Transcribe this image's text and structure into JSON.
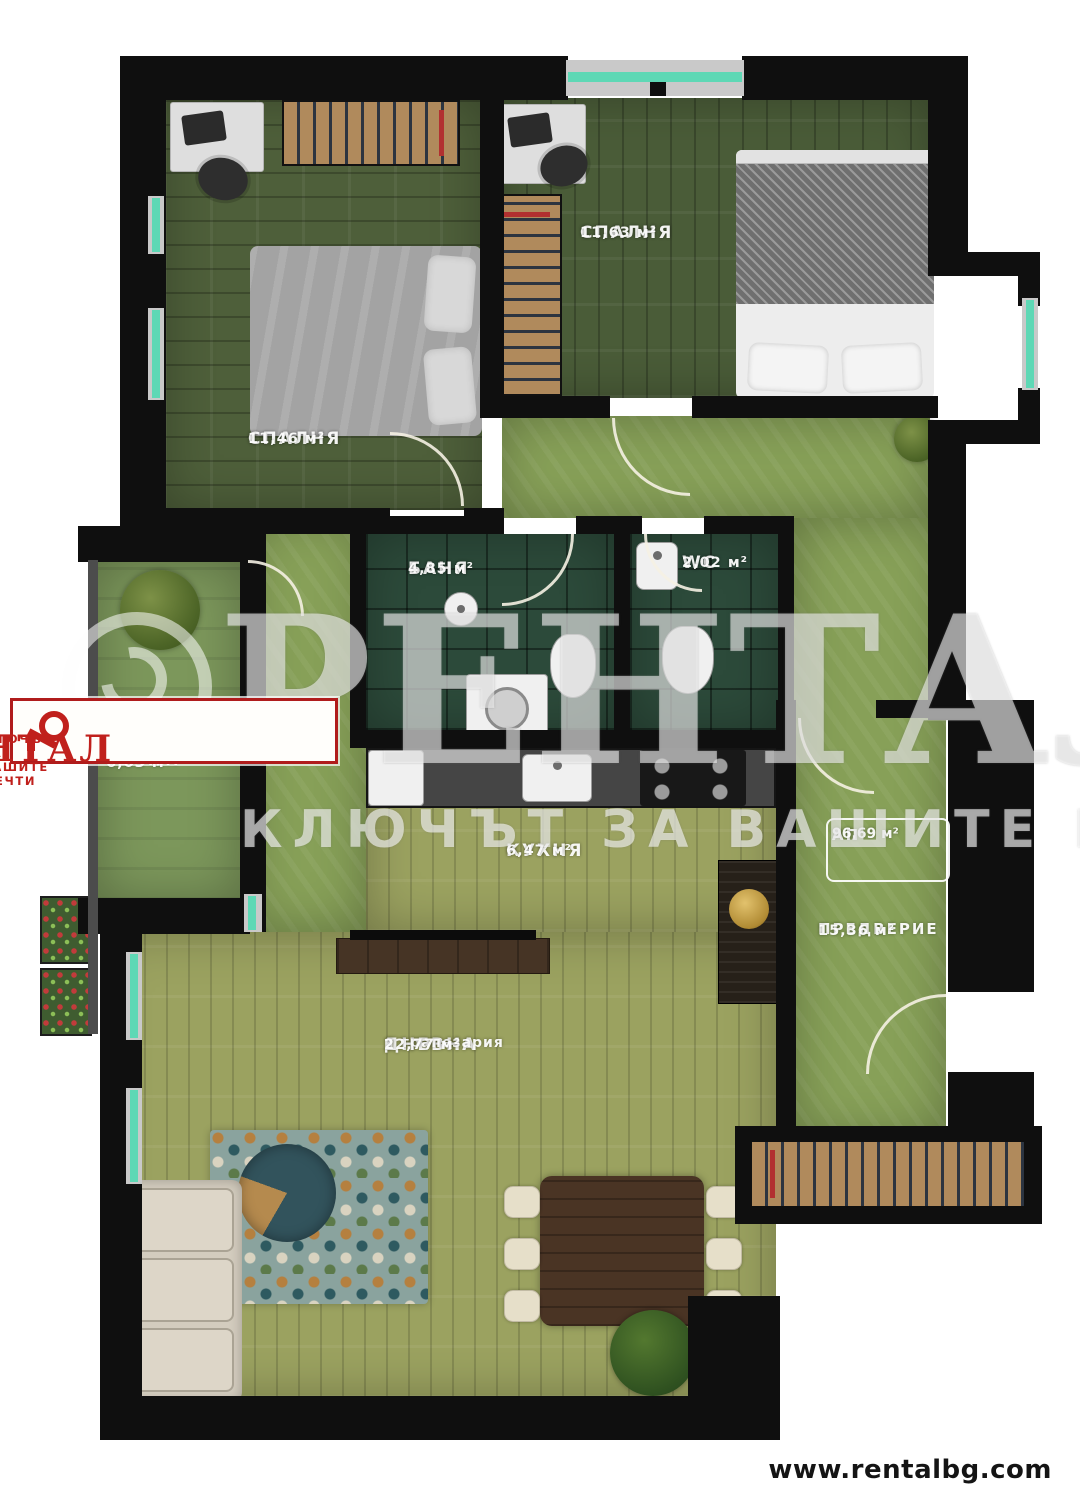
{
  "footer": {
    "website": "www.rentalbg.com"
  },
  "logo": {
    "brand": "РЕНТАЛ",
    "tagline": "КЛЮЧЪТ ЗА ВАШИТЕ МЕЧТИ",
    "color": "#c0201c"
  },
  "watermark": {
    "brand": "РЕНТАЛ",
    "tagline": "КЛЮЧЪТ ЗА ВАШИТЕ МЕЧТИ"
  },
  "floorplan": {
    "rooms": [
      {
        "id": "bedroom-left",
        "label": "СПАЛНЯ",
        "area": "11,46 м²"
      },
      {
        "id": "bedroom-right",
        "label": "СПАЛНЯ",
        "area": "11,63 м²"
      },
      {
        "id": "bathroom",
        "label": "БАНЯ",
        "area": "4,85 м²"
      },
      {
        "id": "wc",
        "label": "WC",
        "area": "2,02 м²"
      },
      {
        "id": "kitchen",
        "label": "КУХНЯ",
        "area": "6,47 м²"
      },
      {
        "id": "living-dining",
        "label": "ДНЕВНА",
        "sublabel": "и трапезария",
        "area": "22,77 м²"
      },
      {
        "id": "entry-hall",
        "label": "ПРЕДВЕРИЕ",
        "area": "15,36 м²"
      },
      {
        "id": "terrace",
        "label": "ТЕРАСА",
        "area": "6,03 м²"
      }
    ],
    "unit": {
      "label": "АП",
      "area": "96,69 м²"
    },
    "colors": {
      "wall": "#0f0f0f",
      "window_glass": "#5ed8b5",
      "floor_dark_wood": "#4e5f3a",
      "floor_light_wood": "#9ba260",
      "floor_hall": "#87a058",
      "floor_tile": "#2c4a3a",
      "logo_red": "#c0201c"
    }
  }
}
